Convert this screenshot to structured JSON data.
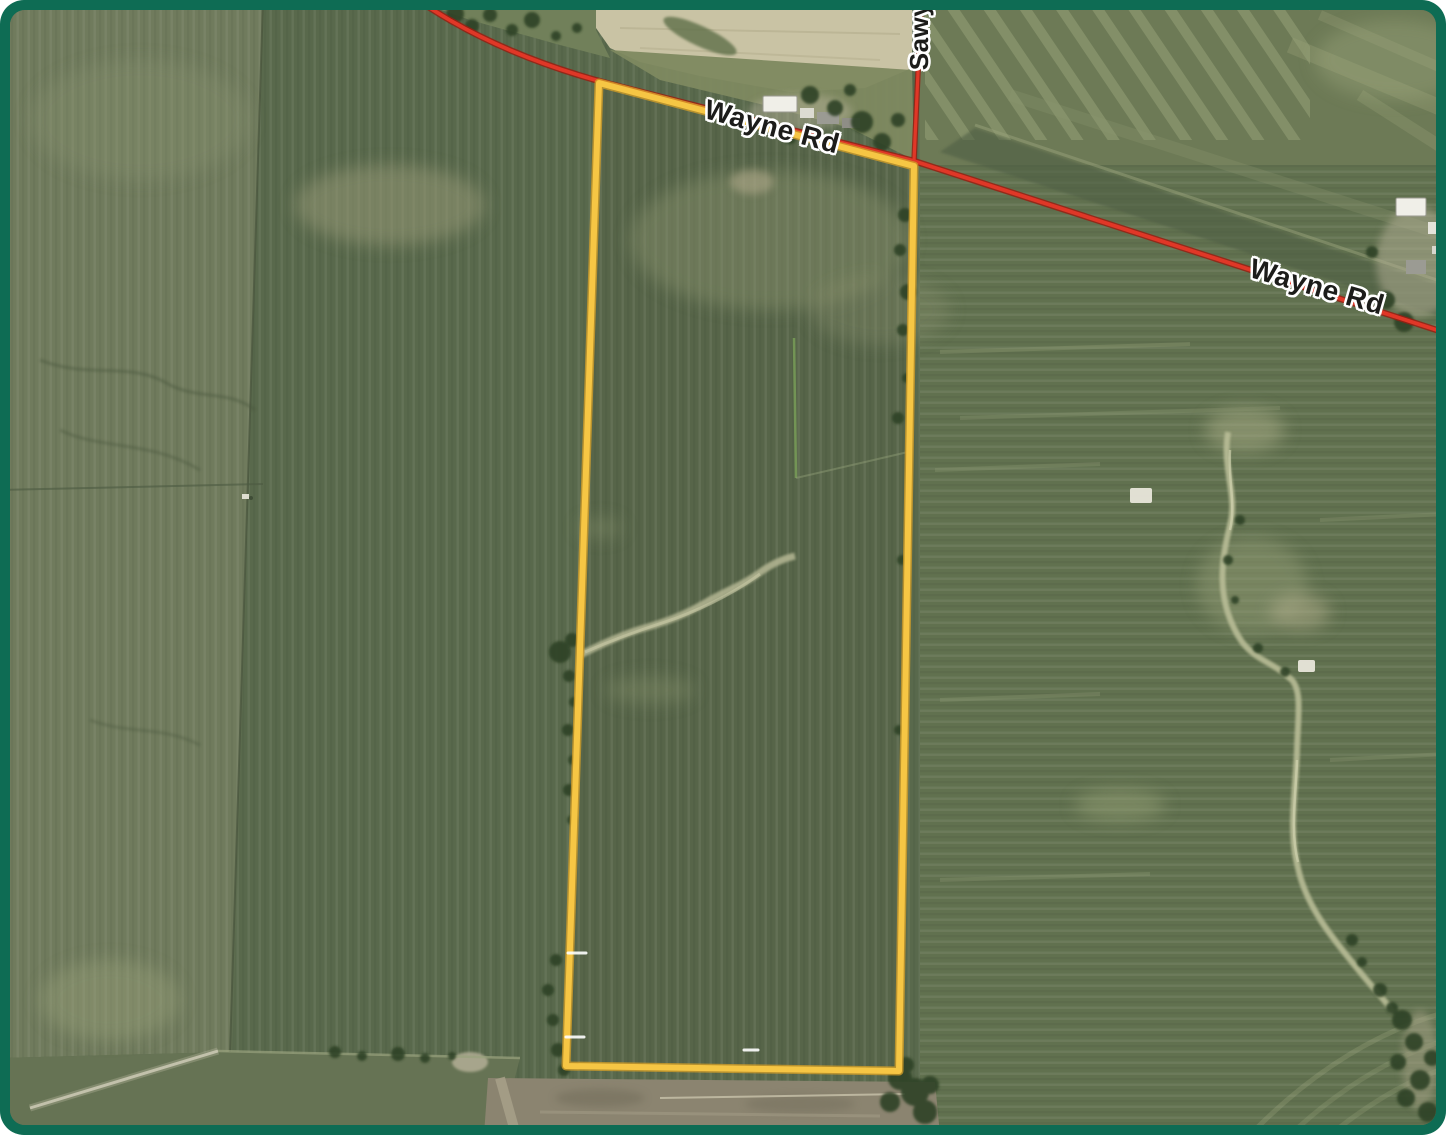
{
  "map": {
    "view_type": "satellite-aerial-parcel-view",
    "road_labels": [
      {
        "id": "wayne-rd-west",
        "text": "Wayne Rd"
      },
      {
        "id": "wayne-rd-east",
        "text": "Wayne Rd"
      },
      {
        "id": "sawyer-rd-partial",
        "text": "Sawy"
      }
    ],
    "parcel": {
      "shape": "elongated rectangle between Wayne Rd and field lane",
      "outline_style": "solid"
    },
    "colors": {
      "frame": "#0e6c54",
      "parcel": "#f6c644",
      "parcel_casing": "#cf9c28",
      "road": "#e03727",
      "road_casing": "#991f12",
      "label_text": "#1c1c1a",
      "label_halo": "#ffffff"
    }
  }
}
